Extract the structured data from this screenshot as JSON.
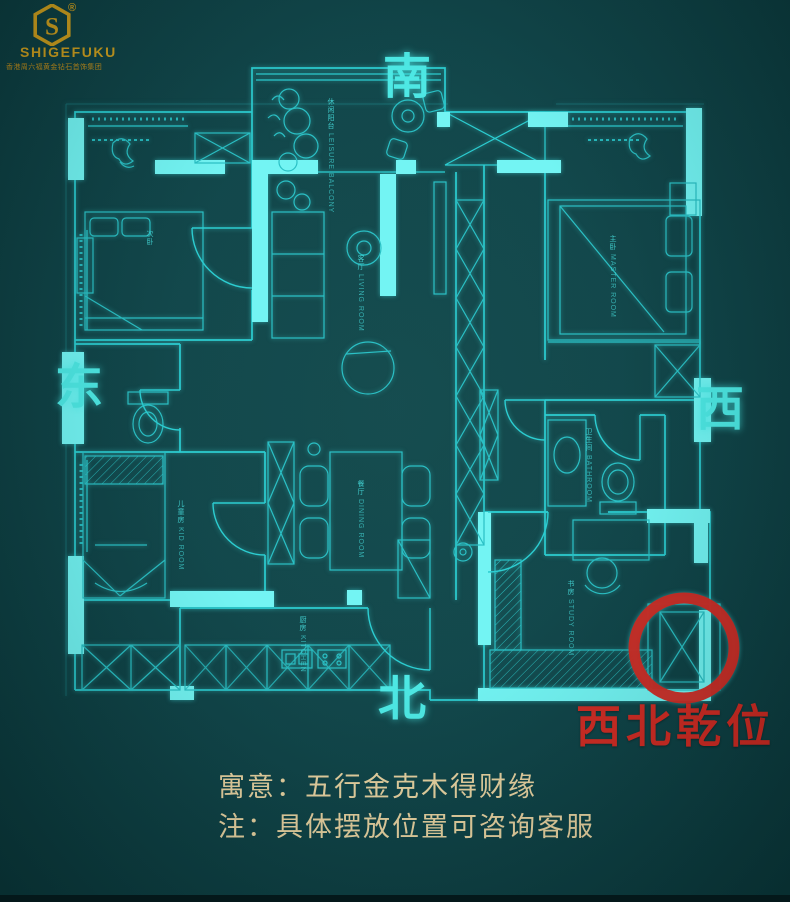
{
  "brand": {
    "logo_letter": "S",
    "registered": "®",
    "name": "SHIGEFUKU",
    "tagline": "香港周六福黄金钻石首饰集团"
  },
  "compass": {
    "south": "南",
    "east": "东",
    "west": "西",
    "north": "北"
  },
  "annotation": {
    "position_label": "西北乾位",
    "meaning": "寓意：五行金克木得财缘",
    "note": "注：具体摆放位置可咨询客服"
  },
  "floorplan": {
    "rooms": [
      {
        "id": "leisure-balcony",
        "label": "休闲阳台",
        "sublabel": "LEISURE BALCONY"
      },
      {
        "id": "living-room",
        "label": "客厅",
        "sublabel": "LIVING ROOM"
      },
      {
        "id": "dining-room",
        "label": "餐厅",
        "sublabel": "DINING ROOM"
      },
      {
        "id": "kitchen",
        "label": "厨房",
        "sublabel": "KITCHEN"
      },
      {
        "id": "master-bedroom",
        "label": "主卧",
        "sublabel": "MASTER ROOM"
      },
      {
        "id": "second-bedroom",
        "label": "次卧",
        "sublabel": ""
      },
      {
        "id": "kids-room",
        "label": "儿童房",
        "sublabel": "KID ROOM"
      },
      {
        "id": "bathroom",
        "label": "卫生间",
        "sublabel": "BATHROOM"
      },
      {
        "id": "study",
        "label": "书房",
        "sublabel": "STUDY ROOM"
      }
    ]
  },
  "colors": {
    "background": "#0d4347",
    "line_cyan": "#28ccd0",
    "wall_highlight": "#70f4f3",
    "compass_cyan": "#4ae8e4",
    "accent_red": "#cf2a22",
    "brand_gold": "#c79b1d",
    "note_gold": "#e6d2a0"
  }
}
